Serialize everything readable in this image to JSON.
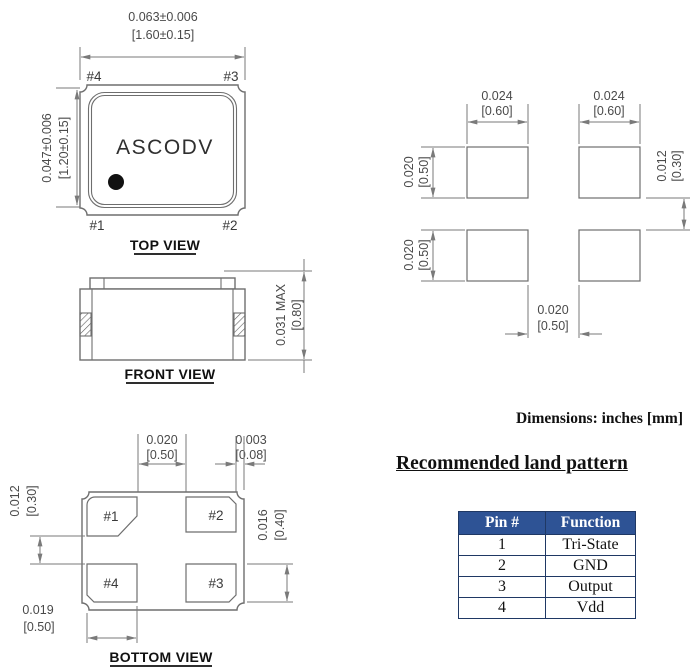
{
  "notes": {
    "units": "Dimensions: inches [mm]"
  },
  "top_view": {
    "label": "TOP VIEW",
    "marking": "ASCODV",
    "pin_top_left": "#4",
    "pin_top_right": "#3",
    "pin_bottom_left": "#1",
    "pin_bottom_right": "#2",
    "width_in": "0.063±0.006",
    "width_mm": "[1.60±0.15]",
    "height_in": "0.047±0.006",
    "height_mm": "[1.20±0.15]"
  },
  "front_view": {
    "label": "FRONT VIEW",
    "height_in": "0.031 MAX",
    "height_mm": "[0.80]"
  },
  "land_pattern": {
    "pad_w_left_in": "0.024",
    "pad_w_left_mm": "[0.60]",
    "pad_w_right_in": "0.024",
    "pad_w_right_mm": "[0.60]",
    "pad_h_top_in": "0.020",
    "pad_h_top_mm": "[0.50]",
    "pad_h_bottom_in": "0.020",
    "pad_h_bottom_mm": "[0.50]",
    "row_gap_in": "0.012",
    "row_gap_mm": "[0.30]",
    "col_gap_in": "0.020",
    "col_gap_mm": "[0.50]"
  },
  "bottom_view": {
    "label": "BOTTOM VIEW",
    "pad_top_left": "#1",
    "pad_top_right": "#2",
    "pad_bottom_left": "#4",
    "pad_bottom_right": "#3",
    "pad_gap_in": "0.020",
    "pad_gap_mm": "[0.50]",
    "edge_gap_in": "0.003",
    "edge_gap_mm": "[0.08]",
    "row_gap_in": "0.012",
    "row_gap_mm": "[0.30]",
    "pad_h_in": "0.016",
    "pad_h_mm": "[0.40]",
    "pad_w_in": "0.019",
    "pad_w_mm": "[0.50]"
  },
  "land_section": {
    "heading": "Recommended land pattern",
    "table": {
      "headers": [
        "Pin #",
        "Function"
      ],
      "rows": [
        [
          "1",
          "Tri-State"
        ],
        [
          "2",
          "GND"
        ],
        [
          "3",
          "Output"
        ],
        [
          "4",
          "Vdd"
        ]
      ]
    }
  },
  "colors": {
    "table_header_bg": "#2E5395",
    "table_border": "#1F3864",
    "drawing_line": "#6e6e6e",
    "dimension_text": "#4a4a4a"
  }
}
